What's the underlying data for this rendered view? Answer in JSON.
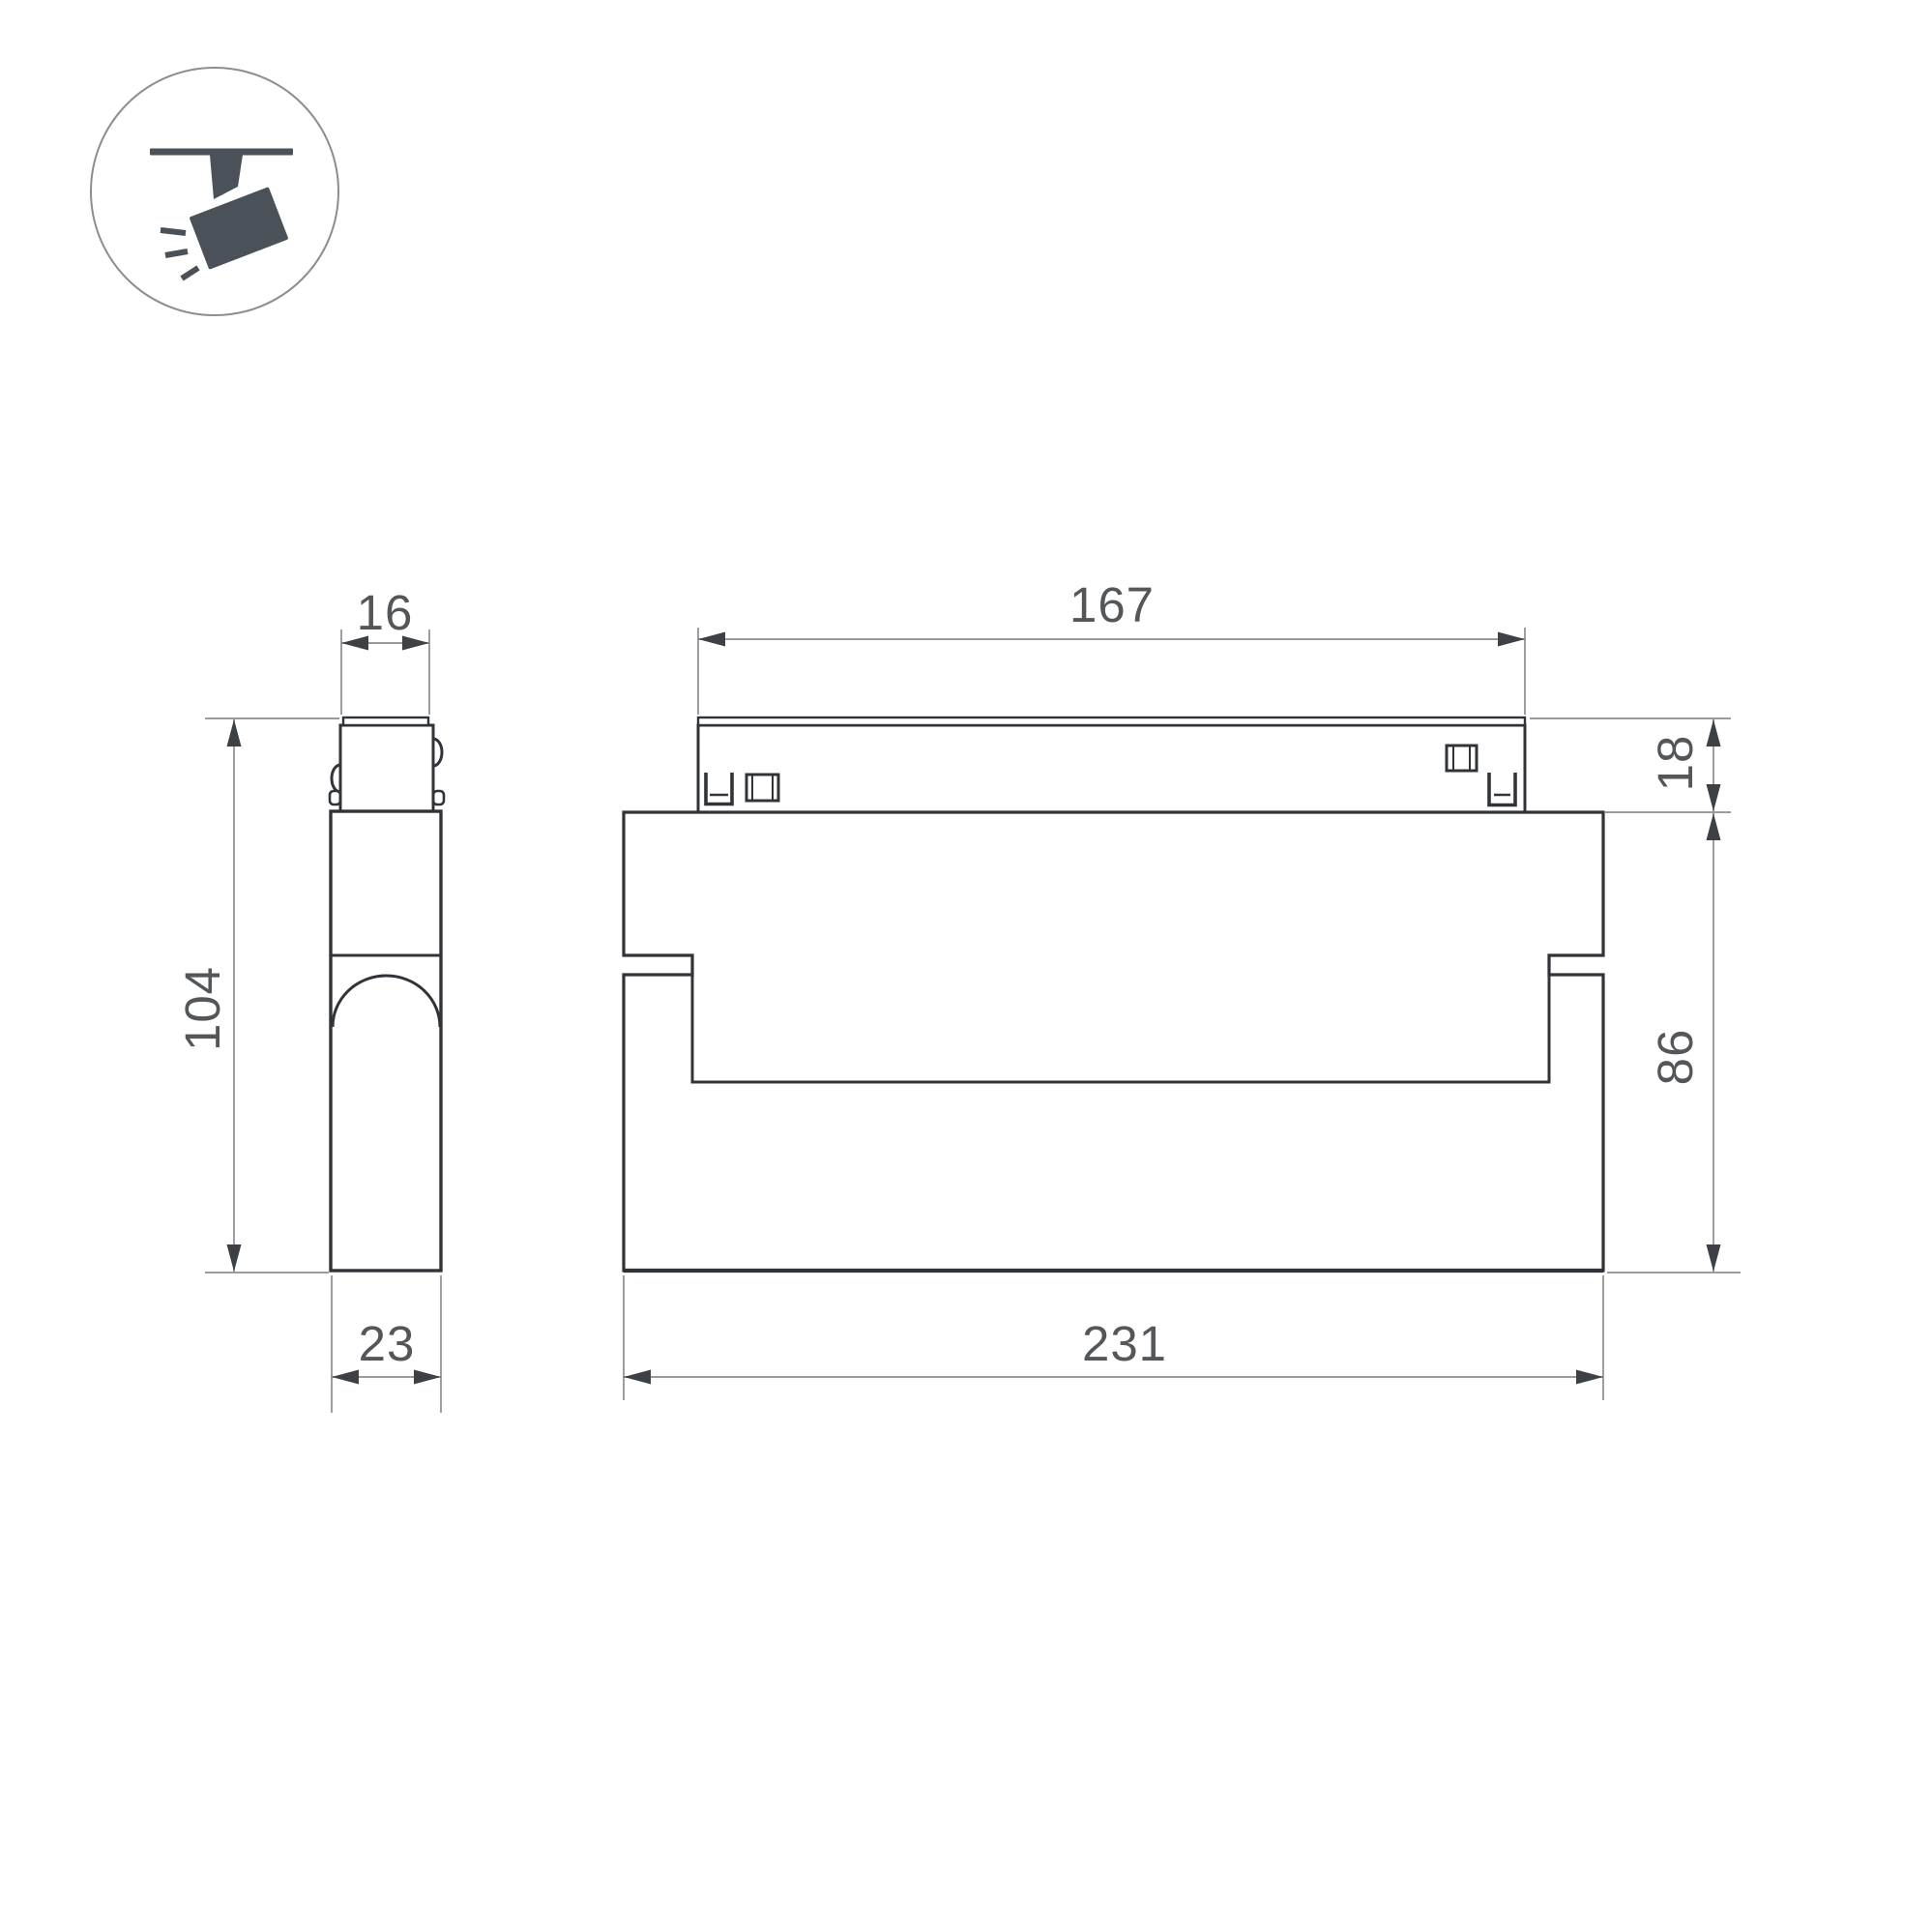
{
  "drawing": {
    "icon": {
      "name": "ceiling-track-spotlight"
    },
    "side_view": {
      "track_width": "16",
      "overall_height": "104",
      "body_depth": "23"
    },
    "front_view": {
      "adapter_length": "167",
      "adapter_height": "18",
      "body_height": "86",
      "body_length": "231"
    },
    "colors": {
      "outline": "#303438",
      "dim_line": "#8b8d90",
      "arrow": "#3d4145",
      "text": "#54575a",
      "icon": "#4a5158",
      "icon_circle_stroke": "#8b8d90",
      "background": "#ffffff"
    }
  }
}
